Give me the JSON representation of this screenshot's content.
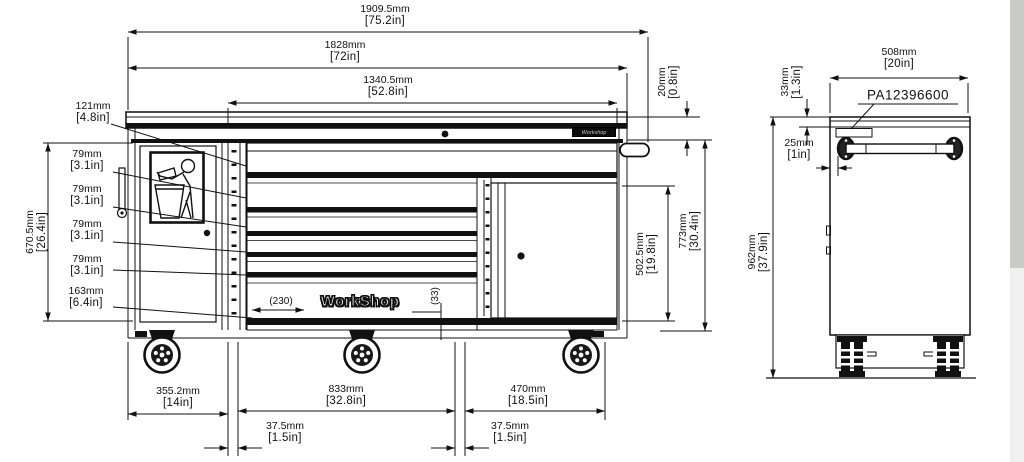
{
  "front_view": {
    "dims": {
      "overall_width": {
        "mm": "1909.5mm",
        "in": "[75.2in]"
      },
      "body_width": {
        "mm": "1828mm",
        "in": "[72in]"
      },
      "top_drawer_width": {
        "mm": "1340.5mm",
        "in": "[52.8in]"
      },
      "top_drawer_height": {
        "mm": "121mm",
        "in": "[4.8in]"
      },
      "drawer2_height": {
        "mm": "79mm",
        "in": "[3.1in]"
      },
      "drawer3_height": {
        "mm": "79mm",
        "in": "[3.1in]"
      },
      "drawer4_height": {
        "mm": "79mm",
        "in": "[3.1in]"
      },
      "drawer5_height": {
        "mm": "79mm",
        "in": "[3.1in]"
      },
      "bottom_drawer_height": {
        "mm": "163mm",
        "in": "[6.4in]"
      },
      "drawer_stack_height": {
        "mm": "670.5mm",
        "in": "[26.4in]"
      },
      "worktop_overhang": {
        "mm": "20mm",
        "in": "[0.8in]"
      },
      "door_opening_height": {
        "mm": "502.5mm",
        "in": "[19.8in]"
      },
      "body_height": {
        "mm": "773mm",
        "in": "[30.4in]"
      },
      "left_section_width": {
        "mm": "355.2mm",
        "in": "[14in]"
      },
      "center_section_width": {
        "mm": "833mm",
        "in": "[32.8in]"
      },
      "right_section_width": {
        "mm": "470mm",
        "in": "[18.5in]"
      },
      "left_divider_width": {
        "mm": "37.5mm",
        "in": "[1.5in]"
      },
      "right_divider_width": {
        "mm": "37.5mm",
        "in": "[1.5in]"
      },
      "logo_width_ref": "(230)",
      "logo_height_ref": "(33)"
    },
    "logo_text": "WorkShop",
    "brand_label": "Workshop"
  },
  "side_view": {
    "dims": {
      "depth": {
        "mm": "508mm",
        "in": "[20in]"
      },
      "top_rail_height": {
        "mm": "33mm",
        "in": "[1.3in]"
      },
      "label_inset": {
        "mm": "25mm",
        "in": "[1in]"
      },
      "overall_height": {
        "mm": "962mm",
        "in": "[37.9in]"
      }
    },
    "part_number": "PA12396600"
  },
  "colors": {
    "line": "#111111",
    "paper": "#ffffff",
    "margin_dark": "#c9cbc9",
    "margin_light": "#f0f0f1"
  }
}
